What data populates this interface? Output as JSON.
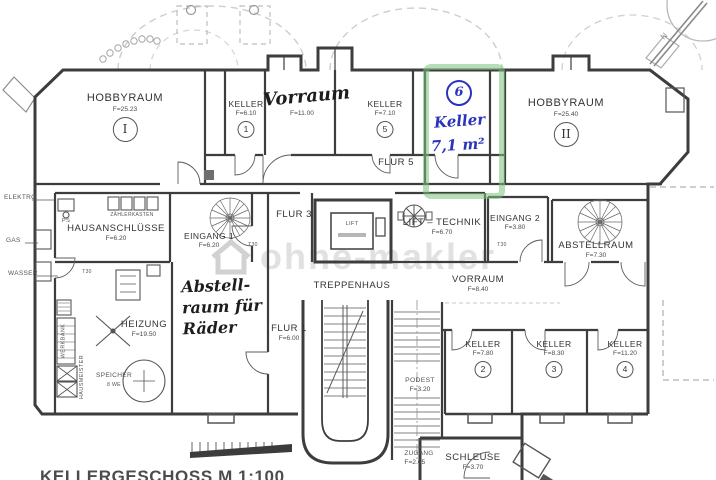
{
  "meta": {
    "title": "KELLERGESCHOSS  M 1:100"
  },
  "watermark": {
    "text": "ohne-makler"
  },
  "compass": {
    "label": "N"
  },
  "highlight": {
    "number": "6",
    "name": "Keller",
    "area": "7,1 m²"
  },
  "handwriting": {
    "vorraum": "Vorraum",
    "line1": "Abstell-",
    "line2": "raum für",
    "line3": "Räder"
  },
  "utilities": {
    "elektro": "ELEKTRO",
    "gas": "GAS",
    "wasser": "WASSER"
  },
  "small": {
    "ps": "PS",
    "zaehlerkasten": "ZÄHLERKASTEN",
    "t30": "T30",
    "werkbank": "WERKBANK",
    "hausmeister": "HAUSMEISTER",
    "speicher": "SPEICHER",
    "speicher_sub": "8 WE",
    "lift": "LIFT"
  },
  "rooms": [
    {
      "name": "HOBBYRAUM",
      "area": "F=25.23",
      "num": "I"
    },
    {
      "name": "KELLER",
      "area": "F=6.10",
      "num": "1"
    },
    {
      "name": "",
      "area": "F=11.00"
    },
    {
      "name": "KELLER",
      "area": "F=7.10",
      "num": "5"
    },
    {
      "name": "HOBBYRAUM",
      "area": "F=25.40",
      "num": "II"
    },
    {
      "name": "FLUR 5",
      "area": ""
    },
    {
      "name": "HAUSANSCHLÜSSE",
      "area": "F=6.20"
    },
    {
      "name": "EINGANG 1",
      "area": "F=6.20"
    },
    {
      "name": "FLUR 3",
      "area": ""
    },
    {
      "name": "LIFT – TECHNIK",
      "area": "F=6.70"
    },
    {
      "name": "EINGANG 2",
      "area": "F=3.80"
    },
    {
      "name": "ABSTELLRAUM",
      "area": "F=7.30"
    },
    {
      "name": "VORRAUM",
      "area": "F=8.40"
    },
    {
      "name": "TREPPENHAUS",
      "area": ""
    },
    {
      "name": "HEIZUNG",
      "area": "F=19.50"
    },
    {
      "name": "FLUR 1",
      "area": "F=6.00"
    },
    {
      "name": "PODEST",
      "area": "F=3.20"
    },
    {
      "name": "KELLER",
      "area": "F=7.80",
      "num": "2"
    },
    {
      "name": "KELLER",
      "area": "F=8.30",
      "num": "3"
    },
    {
      "name": "KELLER",
      "area": "F=11.20",
      "num": "4"
    },
    {
      "name": "ZUGANG",
      "area": "F=2.65"
    },
    {
      "name": "SCHLEUSE",
      "area": "F=3.70"
    }
  ]
}
